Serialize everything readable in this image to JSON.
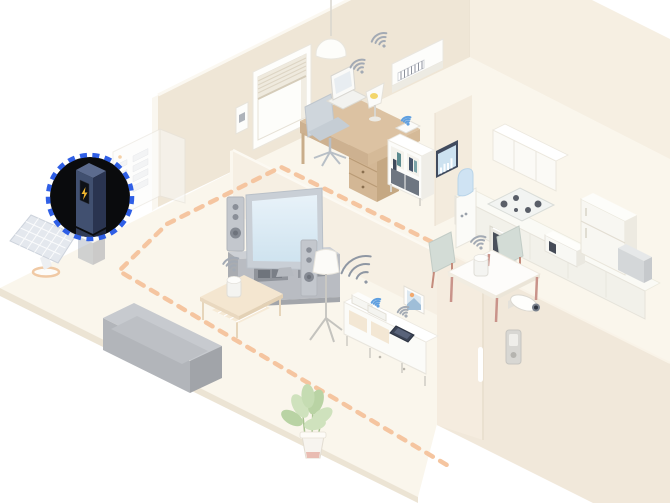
{
  "scene": {
    "title": "smart-home-isometric-illustration",
    "background": "#ffffff",
    "palette": {
      "floor": "#faf6ec",
      "floor_edge": "#ece4d4",
      "wall_nw": "#efe6d6",
      "wall_ne": "#f6efe2",
      "wall_se": "#f1e8da",
      "partition": "#f6efe3",
      "door_panel": "#f5ecdf"
    },
    "highlight": {
      "device": "home-battery",
      "ring_color": "#2f5fe6",
      "spotlight_color": "#0a0b0d",
      "bolt_color": "#f2b72e",
      "battery_front": "#415070",
      "battery_side": "#2a3450",
      "battery_top": "#5c6b8e"
    },
    "energy_flow": {
      "color": "#f5c5a0",
      "style": "dashed",
      "route": [
        "kitchen",
        "dining",
        "battery",
        "living-room",
        "front-exit"
      ]
    },
    "wifi": {
      "color": "#9aa2ad",
      "router_color": "#8f97a3",
      "accent_blue": "#5f9fe0",
      "connected_devices": [
        "air-conditioner",
        "laptop",
        "desk-lamp",
        "smart-speaker-living",
        "smart-speaker-dining",
        "tablet",
        "shelf-hub",
        "sideboard-hub"
      ]
    },
    "devices": [
      "solar-panel",
      "home-battery",
      "distribution-board",
      "window-blinds",
      "wall-thermostat",
      "pendant-light",
      "air-conditioner",
      "desk",
      "office-chair",
      "laptop",
      "desk-lamp",
      "bookshelf",
      "wireless-hub",
      "hems-energy-monitor",
      "wall-cabinets",
      "kitchen-counter",
      "induction-cooktop",
      "built-in-oven",
      "microwave-oven",
      "refrigerator",
      "kitchen-stool",
      "water-dispenser",
      "dining-table",
      "dining-chairs",
      "smart-speaker-dining",
      "smart-speaker-living",
      "television",
      "tv-stand",
      "speaker-towers",
      "floor-lamp",
      "coffee-table",
      "sofa",
      "houseplant",
      "sideboard",
      "wifi-router",
      "tablet",
      "photo-frame",
      "front-door",
      "door-handle",
      "security-camera",
      "video-intercom"
    ]
  }
}
